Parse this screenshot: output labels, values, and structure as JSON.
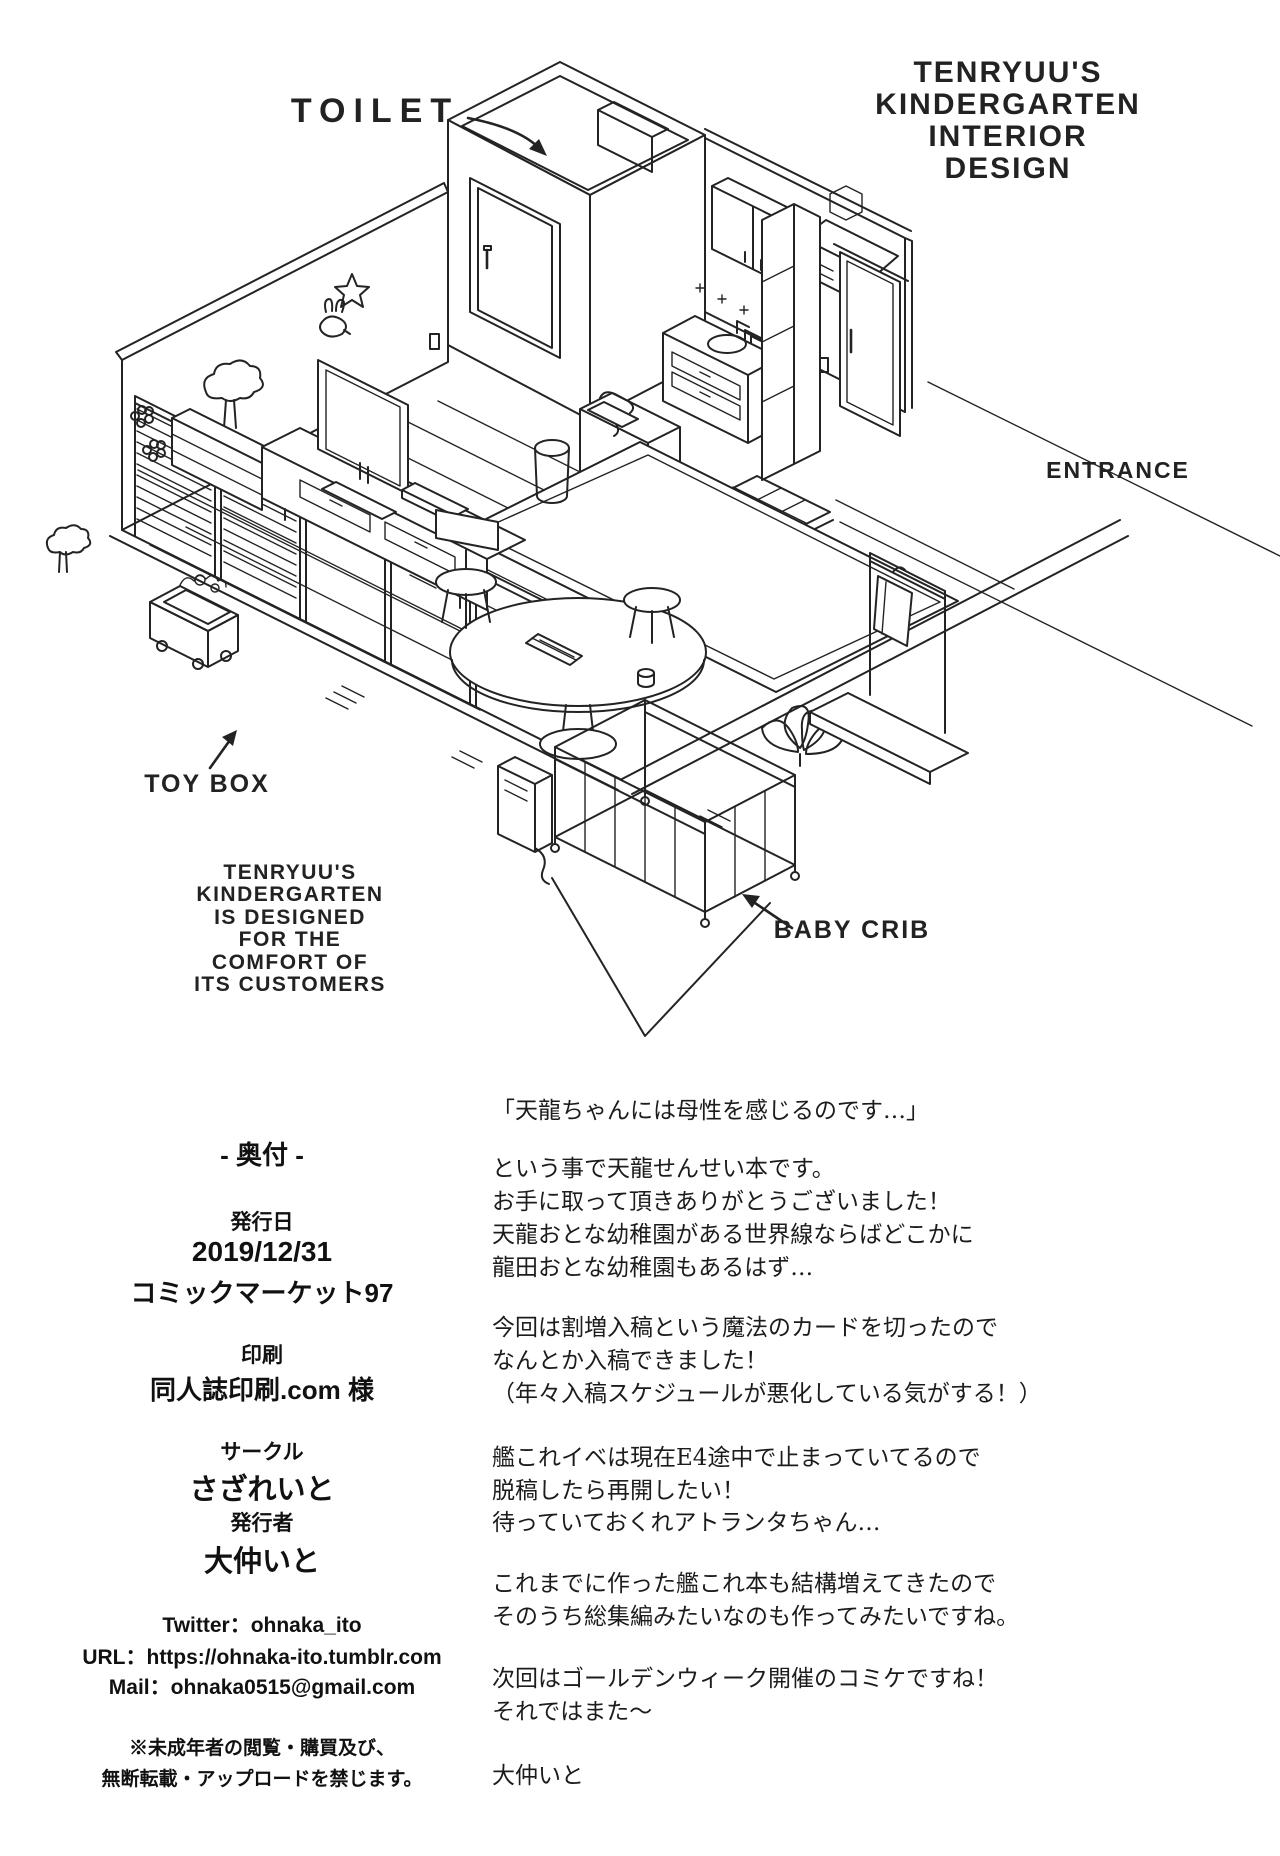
{
  "page": {
    "background": "#ffffff",
    "ink": "#232323"
  },
  "illustration": {
    "title_lines": [
      "TENRYUU'S",
      "KINDERGARTEN",
      "INTERIOR",
      "DESIGN"
    ],
    "labels": {
      "toilet": "TOILET",
      "entrance": "ENTRANCE",
      "toy_box": "TOY BOX",
      "baby_crib": "BABY CRIB"
    },
    "caption_lines": [
      "TENRYUU'S",
      "KINDERGARTEN",
      "IS DESIGNED",
      "FOR THE",
      "COMFORT OF",
      "ITS CUSTOMERS"
    ]
  },
  "colophon": {
    "heading": "- 奥付 -",
    "publish_label": "発行日",
    "publish_date": "2019/12/31",
    "publish_event": "コミックマーケット97",
    "printer_label": "印刷",
    "printer_name": "同人誌印刷.com 様",
    "circle_label": "サークル",
    "circle_name": "さざれいと",
    "publisher_label": "発行者",
    "publisher_name": "大仲いと",
    "twitter": "Twitter：ohnaka_ito",
    "url": "URL：https://ohnaka-ito.tumblr.com",
    "mail": "Mail：ohnaka0515@gmail.com",
    "notice_line1": "※未成年者の閲覧・購買及び、",
    "notice_line2": "無断転載・アップロードを禁じます。"
  },
  "afterword": {
    "lines": [
      "「天龍ちゃんには母性を感じるのです…」",
      "という事で天龍せんせい本です。",
      "お手に取って頂きありがとうございました！",
      "天龍おとな幼稚園がある世界線ならばどこかに",
      "龍田おとな幼稚園もあるはず…",
      "今回は割増入稿という魔法のカードを切ったので",
      "なんとか入稿できました！",
      "（年々入稿スケジュールが悪化している気がする！）",
      "艦これイベは現在E4途中で止まっていてるので",
      "脱稿したら再開したい！",
      "待っていておくれアトランタちゃん…",
      "これまでに作った艦これ本も結構増えてきたので",
      "そのうち総集編みたいなのも作ってみたいですね。",
      "次回はゴールデンウィーク開催のコミケですね！",
      "それではまた〜",
      "大仲いと"
    ]
  }
}
